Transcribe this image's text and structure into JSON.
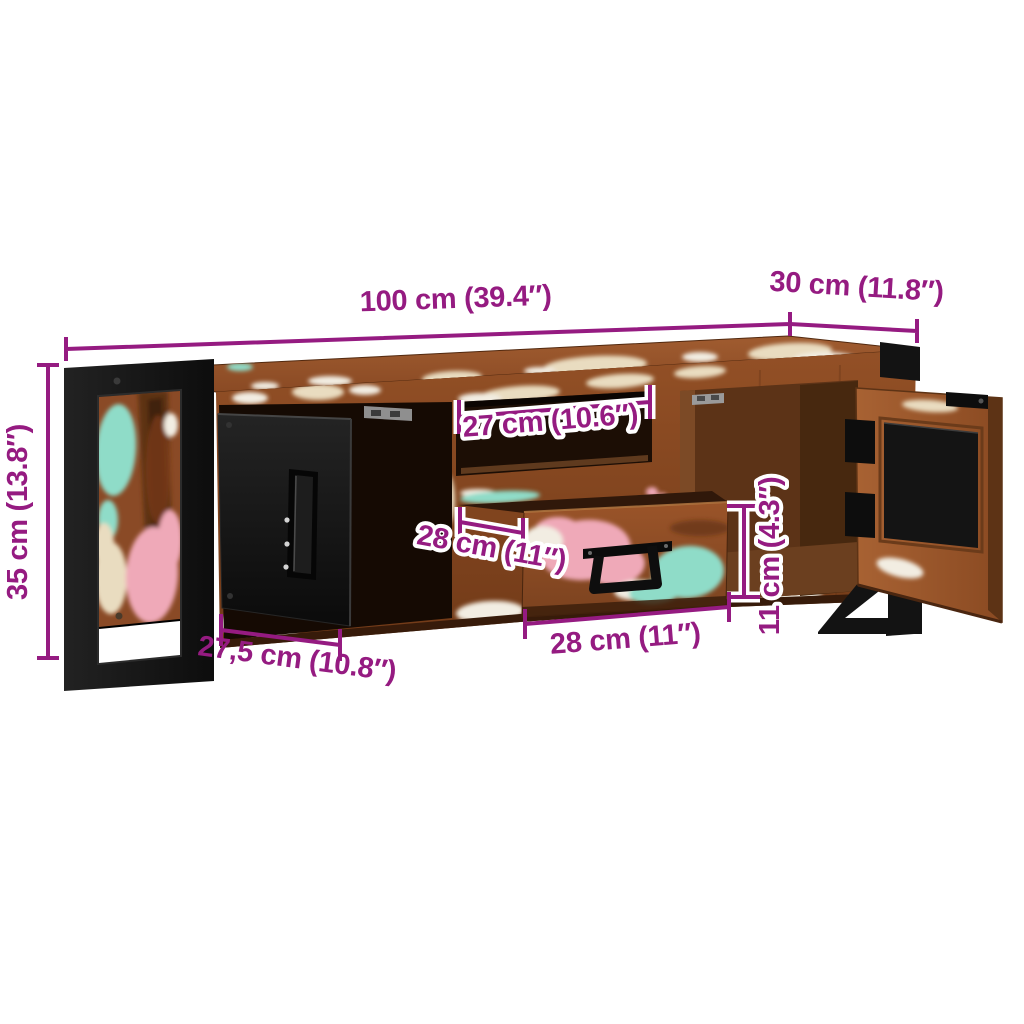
{
  "colors": {
    "background": "#ffffff",
    "dimension": "#951b81",
    "label_outline": "#ffffff",
    "wood_base": "#8a4a26",
    "interior_dark": "#150a03",
    "metal_black": "#131313",
    "paint_cream": "#e9dcc0",
    "paint_white": "#f2ede2",
    "paint_pink": "#efa9b8",
    "paint_teal": "#8fdcc8"
  },
  "dimensions": {
    "width": "100 cm (39.4″)",
    "depth": "30 cm (11.8″)",
    "height": "35 cm (13.8″)",
    "shelf_width": "27 cm (10.6″)",
    "drawer_depth": "28 cm (11″)",
    "drawer_width": "28 cm (11″)",
    "drawer_height": "11 cm (4.3″)",
    "door_width": "27,5 cm (10.8″)"
  }
}
